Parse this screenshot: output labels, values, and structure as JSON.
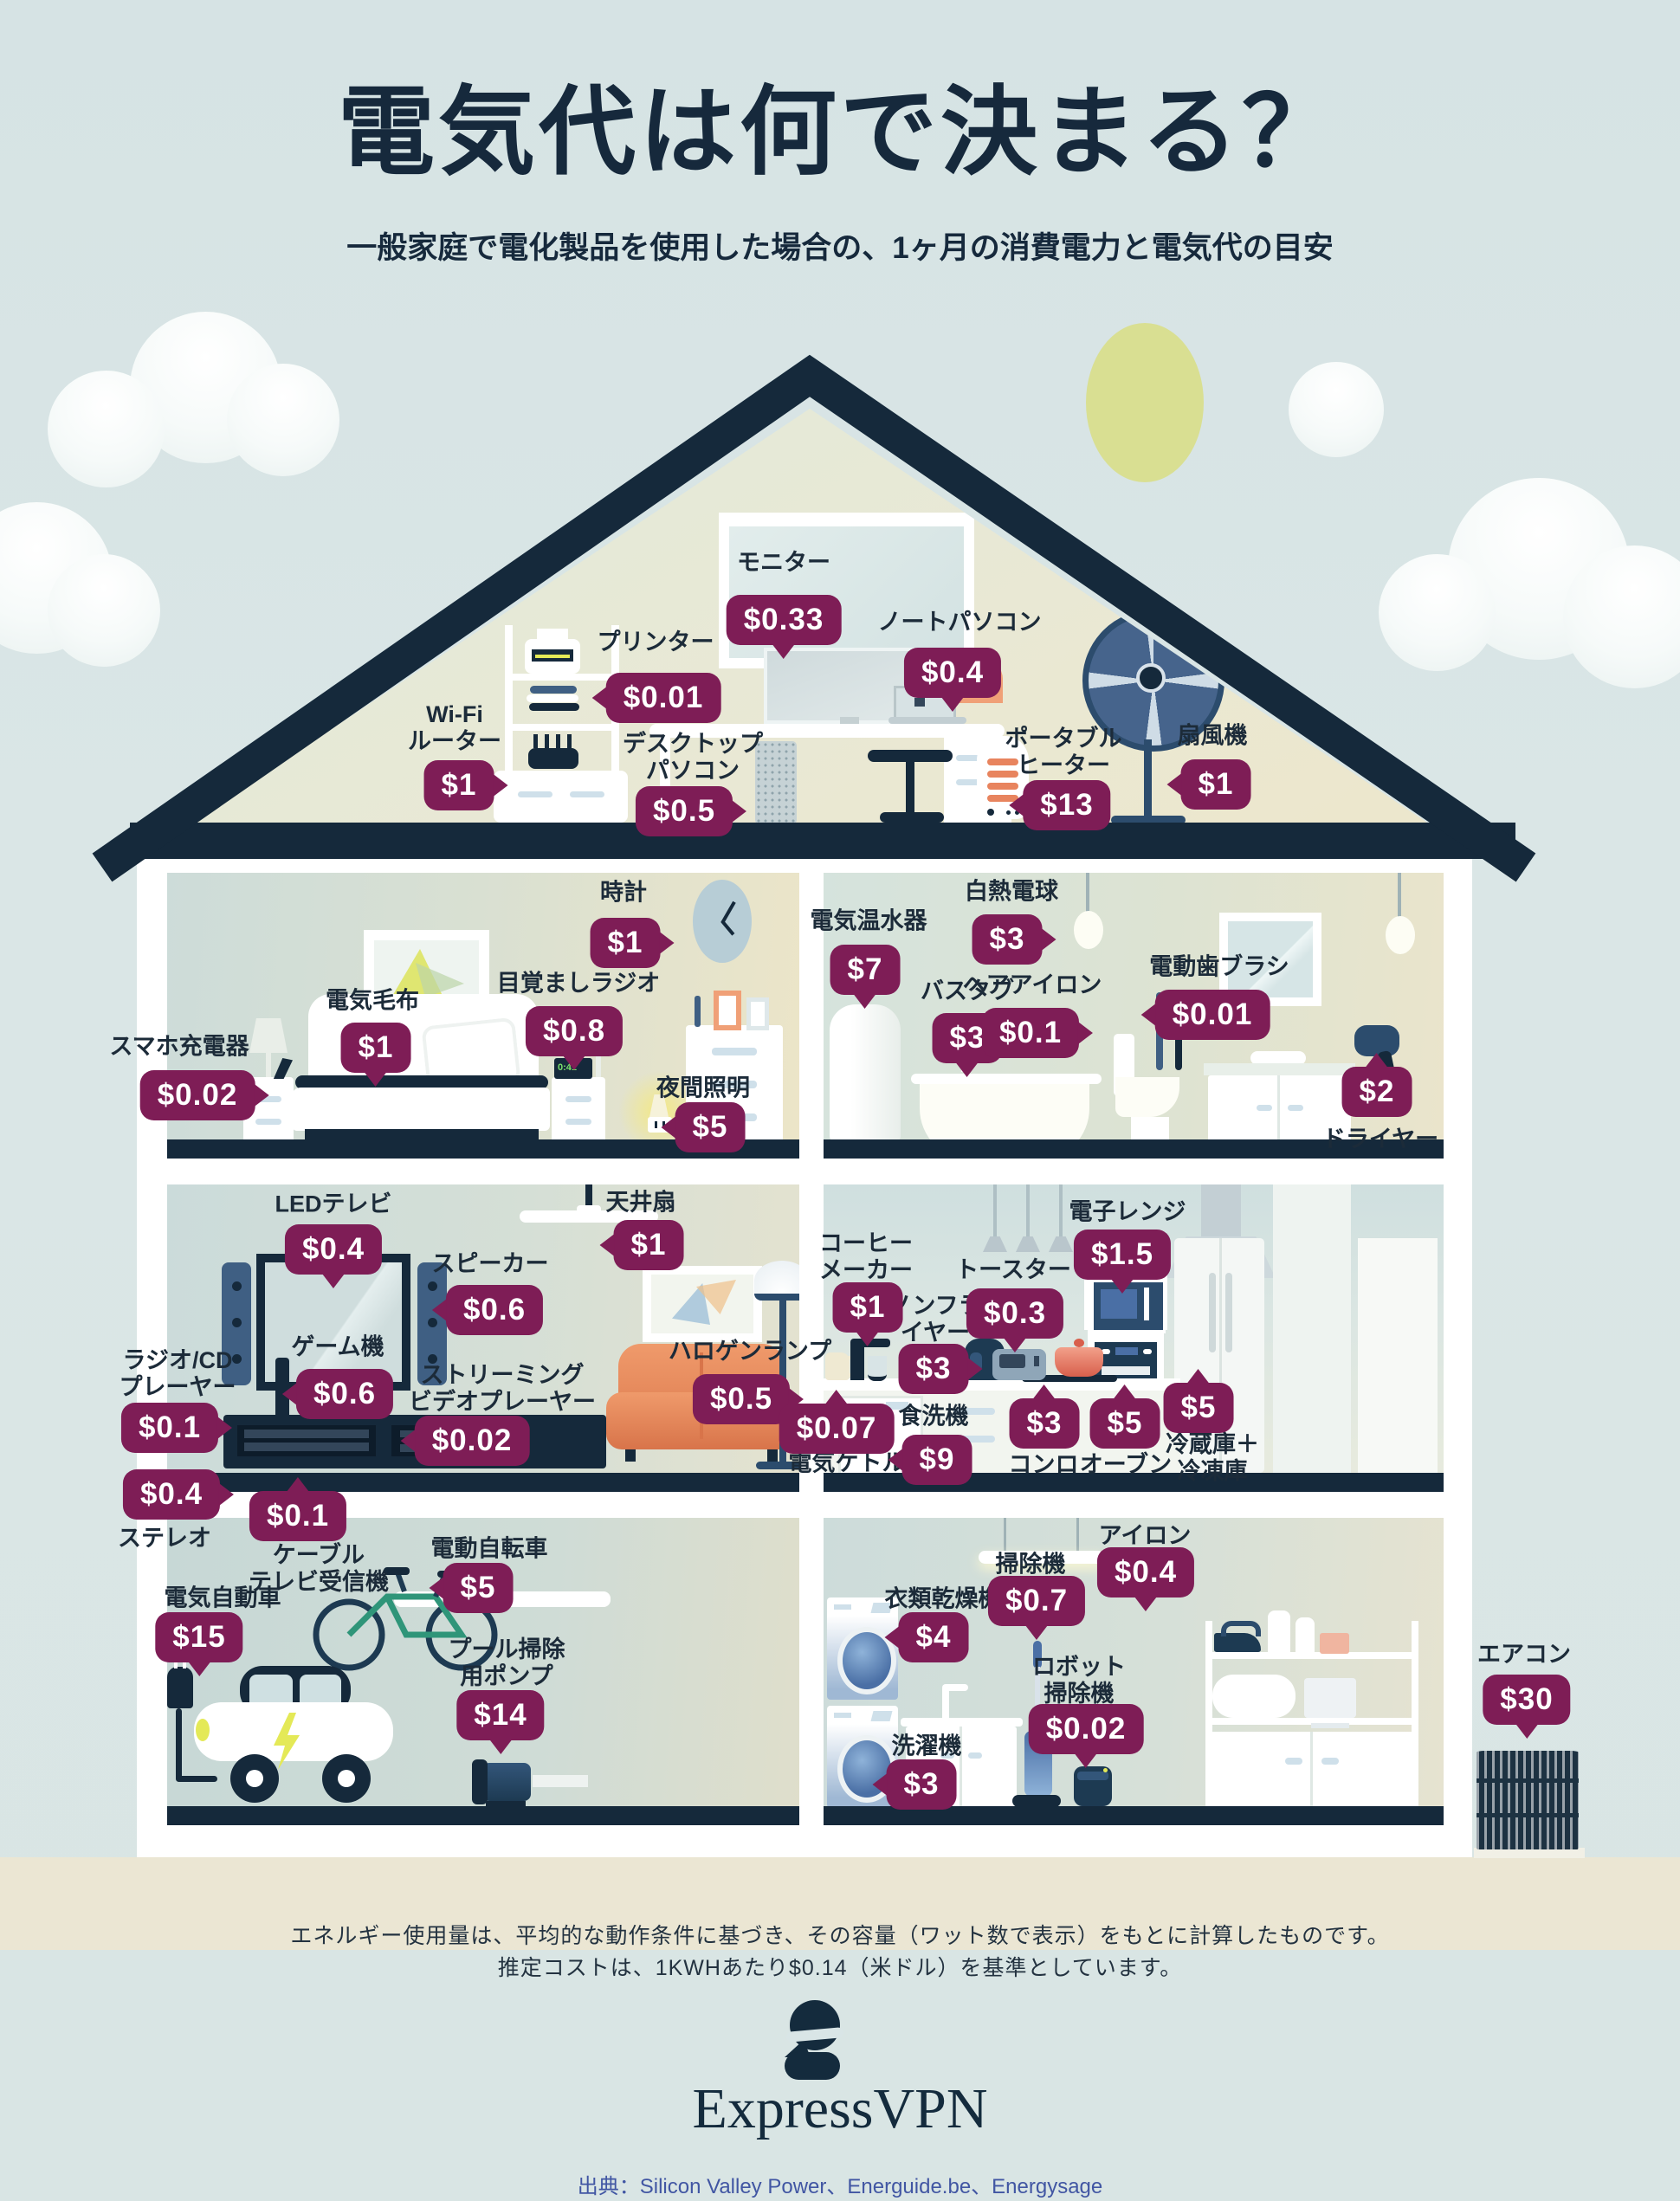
{
  "title": "電気代は何で決まる？",
  "subtitle": "一般家庭で電化製品を使用した場合の、1ヶ月の消費電力と電気代の目安",
  "colors": {
    "bubble_plum": "#7E1D56",
    "roof_navy": "#15293B",
    "sky": "#D9E5E6",
    "sun": "#D9DF92",
    "ground": "#EBE6D3",
    "sofa_orange": "#E8845E",
    "bolt_yellow": "#E4E957",
    "source_blue": "#4156A3"
  },
  "alarm_radio_display": "0:41",
  "items": [
    {
      "id": "monitor",
      "label": "モニター",
      "price": "$0.33",
      "room": "attic"
    },
    {
      "id": "printer",
      "label": "プリンター",
      "price": "$0.01",
      "room": "attic"
    },
    {
      "id": "laptop",
      "label": "ノートパソコン",
      "price": "$0.4",
      "room": "attic"
    },
    {
      "id": "wifi_router",
      "label": "Wi-Fi\nルーター",
      "price": "$1",
      "room": "attic"
    },
    {
      "id": "desktop_pc",
      "label": "デスクトップ\nパソコン",
      "price": "$0.5",
      "room": "attic"
    },
    {
      "id": "portable_heater",
      "label": "ポータブル\nヒーター",
      "price": "$13",
      "room": "attic"
    },
    {
      "id": "floor_fan",
      "label": "扇風機",
      "price": "$1",
      "room": "attic"
    },
    {
      "id": "clock",
      "label": "時計",
      "price": "$1",
      "room": "bedroom"
    },
    {
      "id": "phone_charger",
      "label": "スマホ充電器",
      "price": "$0.02",
      "room": "bedroom"
    },
    {
      "id": "electric_blanket",
      "label": "電気毛布",
      "price": "$1",
      "room": "bedroom"
    },
    {
      "id": "alarm_radio",
      "label": "目覚ましラジオ",
      "price": "$0.8",
      "room": "bedroom"
    },
    {
      "id": "night_light",
      "label": "夜間照明",
      "price": "$5",
      "room": "bedroom"
    },
    {
      "id": "water_heater",
      "label": "電気温水器",
      "price": "$7",
      "room": "bathroom"
    },
    {
      "id": "bathtub",
      "label": "バスタブ",
      "price": "$3",
      "room": "bathroom"
    },
    {
      "id": "incandescent_bulb",
      "label": "白熱電球",
      "price": "$3",
      "room": "bathroom"
    },
    {
      "id": "hair_iron",
      "label": "ヘアアイロン",
      "price": "$0.1",
      "room": "bathroom"
    },
    {
      "id": "electric_toothbrush",
      "label": "電動歯ブラシ",
      "price": "$0.01",
      "room": "bathroom"
    },
    {
      "id": "hair_dryer",
      "label": "ドライヤー",
      "price": "$2",
      "room": "bathroom"
    },
    {
      "id": "led_tv",
      "label": "LEDテレビ",
      "price": "$0.4",
      "room": "living"
    },
    {
      "id": "ceiling_fan",
      "label": "天井扇",
      "price": "$1",
      "room": "living"
    },
    {
      "id": "speaker",
      "label": "スピーカー",
      "price": "$0.6",
      "room": "living"
    },
    {
      "id": "game_console",
      "label": "ゲーム機",
      "price": "$0.6",
      "room": "living"
    },
    {
      "id": "radio_cd_player",
      "label": "ラジオ/CD\nプレーヤー",
      "price": "$0.1",
      "room": "living"
    },
    {
      "id": "stereo",
      "label": "ステレオ",
      "price": "$0.4",
      "room": "living"
    },
    {
      "id": "streaming_player",
      "label": "ストリーミング\nビデオプレーヤー",
      "price": "$0.02",
      "room": "living"
    },
    {
      "id": "halogen_lamp",
      "label": "ハロゲンランプ",
      "price": "$0.5",
      "room": "living"
    },
    {
      "id": "cable_tv_box",
      "label": "ケーブル\nテレビ受信機",
      "price": "$0.1",
      "room": "living"
    },
    {
      "id": "coffee_maker",
      "label": "コーヒー\nメーカー",
      "price": "$1",
      "room": "kitchen"
    },
    {
      "id": "microwave",
      "label": "電子レンジ",
      "price": "$1.5",
      "room": "kitchen"
    },
    {
      "id": "toaster",
      "label": "トースター",
      "price": "$0.3",
      "room": "kitchen"
    },
    {
      "id": "air_fryer",
      "label": "ノンフラ\nイヤー",
      "price": "$3",
      "room": "kitchen"
    },
    {
      "id": "electric_kettle",
      "label": "電気ケトル",
      "price": "$0.07",
      "room": "kitchen"
    },
    {
      "id": "dishwasher",
      "label": "食洗機",
      "price": "$9",
      "room": "kitchen"
    },
    {
      "id": "stove",
      "label": "コンロ",
      "price": "$3",
      "room": "kitchen"
    },
    {
      "id": "oven",
      "label": "オーブン",
      "price": "$5",
      "room": "kitchen"
    },
    {
      "id": "fridge_freezer",
      "label": "冷蔵庫＋\n冷凍庫",
      "price": "$5",
      "room": "kitchen"
    },
    {
      "id": "ev_car",
      "label": "電気自動車",
      "price": "$15",
      "room": "garage"
    },
    {
      "id": "e_bike",
      "label": "電動自転車",
      "price": "$5",
      "room": "garage"
    },
    {
      "id": "pool_pump",
      "label": "プール掃除\n用ポンプ",
      "price": "$14",
      "room": "garage"
    },
    {
      "id": "clothes_dryer",
      "label": "衣類乾燥機",
      "price": "$4",
      "room": "laundry"
    },
    {
      "id": "vacuum",
      "label": "掃除機",
      "price": "$0.7",
      "room": "laundry"
    },
    {
      "id": "robot_vacuum",
      "label": "ロボット\n掃除機",
      "price": "$0.02",
      "room": "laundry"
    },
    {
      "id": "washing_machine",
      "label": "洗濯機",
      "price": "$3",
      "room": "laundry"
    },
    {
      "id": "iron",
      "label": "アイロン",
      "price": "$0.4",
      "room": "laundry"
    },
    {
      "id": "air_conditioner",
      "label": "エアコン",
      "price": "$30",
      "room": "outside"
    }
  ],
  "footer": {
    "note1": "エネルギー使用量は、平均的な動作条件に基づき、その容量（ワット数で表示）をもとに計算したものです。",
    "note2": "推定コストは、1KWHあたり$0.14（米ドル）を基準としています。",
    "brand": "ExpressVPN",
    "source": "出典：Silicon Valley Power、Energuide.be、Energysage"
  }
}
